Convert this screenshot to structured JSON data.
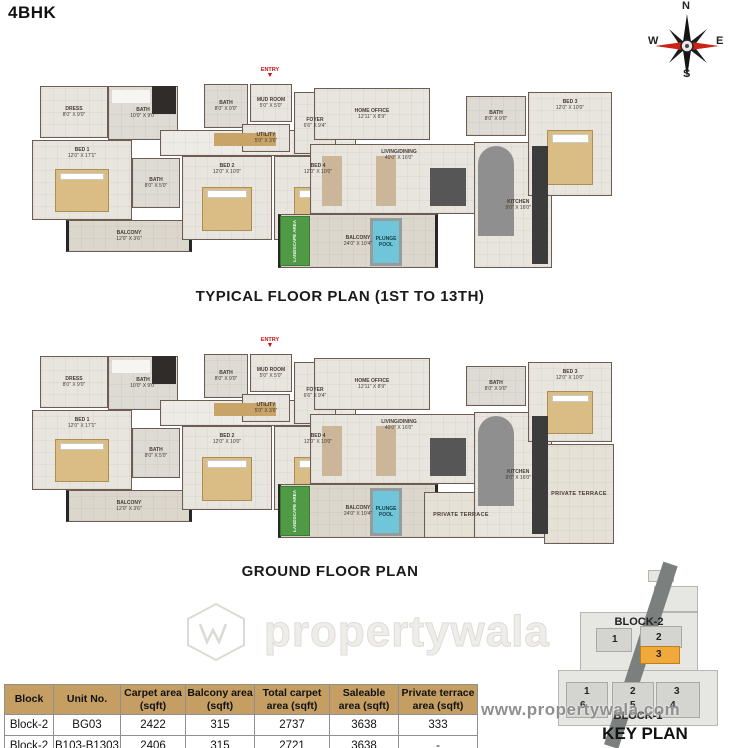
{
  "title": "4BHK",
  "compass": {
    "n": "N",
    "e": "E",
    "s": "S",
    "w": "W"
  },
  "watermark": {
    "brand": "propertywala",
    "url": "www.propertywala.com"
  },
  "plans": [
    {
      "caption": "TYPICAL FLOOR PLAN (1ST TO 13TH)",
      "entry": "ENTRY",
      "rooms": [
        {
          "n": "DRESS",
          "d": "8'0\" X 9'0\"",
          "x": 22,
          "y": 4,
          "w": 68,
          "h": 52,
          "t": "room"
        },
        {
          "n": "BATH",
          "d": "10'0\" X 9'0\"",
          "x": 90,
          "y": 4,
          "w": 70,
          "h": 54,
          "t": "bath"
        },
        {
          "n": "BED 1",
          "d": "12'0\" X 17'1\"",
          "x": 14,
          "y": 58,
          "w": 100,
          "h": 80,
          "t": "bed"
        },
        {
          "n": "BALCONY",
          "d": "12'0\" X 3'6\"",
          "x": 48,
          "y": 138,
          "w": 126,
          "h": 32,
          "t": "balc"
        },
        {
          "n": "",
          "d": "",
          "x": 142,
          "y": 48,
          "w": 196,
          "h": 26,
          "t": "hall"
        },
        {
          "n": "BATH",
          "d": "8'0\" X 5'0\"",
          "x": 114,
          "y": 76,
          "w": 48,
          "h": 50,
          "t": "bath"
        },
        {
          "n": "BED 2",
          "d": "12'0\" X 10'0\"",
          "x": 164,
          "y": 74,
          "w": 90,
          "h": 84,
          "t": "bed"
        },
        {
          "n": "BED 4",
          "d": "12'0\" X 10'0\"",
          "x": 256,
          "y": 74,
          "w": 88,
          "h": 84,
          "t": "bed"
        },
        {
          "n": "BATH",
          "d": "8'0\" X 9'0\"",
          "x": 186,
          "y": 2,
          "w": 44,
          "h": 44,
          "t": "bath"
        },
        {
          "n": "MUD ROOM",
          "d": "5'0\" X 5'0\"",
          "x": 232,
          "y": 2,
          "w": 42,
          "h": 38,
          "t": "room"
        },
        {
          "n": "UTILITY",
          "d": "5'0\" X 3'6\"",
          "x": 224,
          "y": 42,
          "w": 48,
          "h": 28,
          "t": "room"
        },
        {
          "n": "FOYER",
          "d": "6'6\" X 9'4\"",
          "x": 276,
          "y": 10,
          "w": 42,
          "h": 62,
          "t": "room"
        },
        {
          "n": "HOME OFFICE",
          "d": "12'11\" X 8'9\"",
          "x": 296,
          "y": 6,
          "w": 116,
          "h": 52,
          "t": "room"
        },
        {
          "n": "LIVING/DINING",
          "d": "40'0\" X 16'0\"",
          "x": 292,
          "y": 62,
          "w": 178,
          "h": 70,
          "t": "living"
        },
        {
          "n": "BALCONY",
          "d": "24'0\" X 10'4\"",
          "x": 260,
          "y": 132,
          "w": 160,
          "h": 54,
          "t": "balc"
        },
        {
          "n": "LANDSCAPE AREA",
          "d": "",
          "x": 262,
          "y": 134,
          "w": 30,
          "h": 50,
          "t": "green"
        },
        {
          "n": "PLUNGE POOL",
          "d": "",
          "x": 352,
          "y": 136,
          "w": 32,
          "h": 48,
          "t": "pool"
        },
        {
          "n": "KITCHEN",
          "d": "9'0\" X 16'0\"",
          "x": 456,
          "y": 60,
          "w": 78,
          "h": 126,
          "t": "kitchen"
        },
        {
          "n": "BATH",
          "d": "8'0\" X 9'0\"",
          "x": 448,
          "y": 14,
          "w": 60,
          "h": 40,
          "t": "bath"
        },
        {
          "n": "BED 3",
          "d": "12'0\" X 10'0\"",
          "x": 510,
          "y": 10,
          "w": 84,
          "h": 104,
          "t": "bed"
        },
        {
          "n": "",
          "d": "",
          "x": 134,
          "y": 4,
          "w": 24,
          "h": 28,
          "t": "decor",
          "f": "#2f2c2a"
        },
        {
          "n": "",
          "d": "",
          "x": 94,
          "y": 8,
          "w": 38,
          "h": 13,
          "t": "decor",
          "f": "#f6f5f2"
        },
        {
          "n": "",
          "d": "",
          "x": 196,
          "y": 51,
          "w": 62,
          "h": 13,
          "t": "decor",
          "f": "#c9a469"
        },
        {
          "n": "",
          "d": "",
          "x": 304,
          "y": 74,
          "w": 20,
          "h": 50,
          "t": "decor",
          "f": "#cbb69a"
        },
        {
          "n": "",
          "d": "",
          "x": 358,
          "y": 74,
          "w": 20,
          "h": 50,
          "t": "decor",
          "f": "#cbb69a"
        },
        {
          "n": "",
          "d": "",
          "x": 412,
          "y": 86,
          "w": 36,
          "h": 38,
          "t": "decor",
          "f": "#565656"
        },
        {
          "n": "",
          "d": "",
          "x": 460,
          "y": 64,
          "w": 36,
          "h": 90,
          "t": "decor",
          "f": "#8f8f8f",
          "r": "18px 18px 0 0"
        },
        {
          "n": "",
          "d": "",
          "x": 514,
          "y": 64,
          "w": 16,
          "h": 118,
          "t": "decor",
          "f": "#3c3c3c"
        }
      ]
    },
    {
      "caption": "GROUND FLOOR PLAN",
      "entry": "ENTRY",
      "rooms": [
        {
          "n": "DRESS",
          "d": "8'0\" X 9'0\"",
          "x": 22,
          "y": 4,
          "w": 68,
          "h": 52,
          "t": "room"
        },
        {
          "n": "BATH",
          "d": "10'0\" X 9'0\"",
          "x": 90,
          "y": 4,
          "w": 70,
          "h": 54,
          "t": "bath"
        },
        {
          "n": "BED 1",
          "d": "12'0\" X 17'1\"",
          "x": 14,
          "y": 58,
          "w": 100,
          "h": 80,
          "t": "bed"
        },
        {
          "n": "BALCONY",
          "d": "12'0\" X 3'6\"",
          "x": 48,
          "y": 138,
          "w": 126,
          "h": 32,
          "t": "balc"
        },
        {
          "n": "",
          "d": "",
          "x": 142,
          "y": 48,
          "w": 196,
          "h": 26,
          "t": "hall"
        },
        {
          "n": "BATH",
          "d": "8'0\" X 5'0\"",
          "x": 114,
          "y": 76,
          "w": 48,
          "h": 50,
          "t": "bath"
        },
        {
          "n": "BED 2",
          "d": "12'0\" X 10'0\"",
          "x": 164,
          "y": 74,
          "w": 90,
          "h": 84,
          "t": "bed"
        },
        {
          "n": "BED 4",
          "d": "12'0\" X 10'0\"",
          "x": 256,
          "y": 74,
          "w": 88,
          "h": 84,
          "t": "bed"
        },
        {
          "n": "BATH",
          "d": "8'0\" X 9'0\"",
          "x": 186,
          "y": 2,
          "w": 44,
          "h": 44,
          "t": "bath"
        },
        {
          "n": "MUD ROOM",
          "d": "5'0\" X 5'0\"",
          "x": 232,
          "y": 2,
          "w": 42,
          "h": 38,
          "t": "room"
        },
        {
          "n": "UTILITY",
          "d": "5'0\" X 3'6\"",
          "x": 224,
          "y": 42,
          "w": 48,
          "h": 28,
          "t": "room"
        },
        {
          "n": "FOYER",
          "d": "6'6\" X 9'4\"",
          "x": 276,
          "y": 10,
          "w": 42,
          "h": 62,
          "t": "room"
        },
        {
          "n": "HOME OFFICE",
          "d": "12'11\" X 8'9\"",
          "x": 296,
          "y": 6,
          "w": 116,
          "h": 52,
          "t": "room"
        },
        {
          "n": "LIVING/DINING",
          "d": "40'0\" X 16'0\"",
          "x": 292,
          "y": 62,
          "w": 178,
          "h": 70,
          "t": "living"
        },
        {
          "n": "BALCONY",
          "d": "24'0\" X 10'4\"",
          "x": 260,
          "y": 132,
          "w": 160,
          "h": 54,
          "t": "balc"
        },
        {
          "n": "LANDSCAPE AREA",
          "d": "",
          "x": 262,
          "y": 134,
          "w": 30,
          "h": 50,
          "t": "green"
        },
        {
          "n": "PLUNGE POOL",
          "d": "",
          "x": 352,
          "y": 136,
          "w": 32,
          "h": 48,
          "t": "pool"
        },
        {
          "n": "PRIVATE TERRACE",
          "d": "",
          "x": 406,
          "y": 140,
          "w": 74,
          "h": 46,
          "t": "terrace"
        },
        {
          "n": "KITCHEN",
          "d": "9'0\" X 16'0\"",
          "x": 456,
          "y": 60,
          "w": 78,
          "h": 126,
          "t": "kitchen"
        },
        {
          "n": "BATH",
          "d": "8'0\" X 9'0\"",
          "x": 448,
          "y": 14,
          "w": 60,
          "h": 40,
          "t": "bath"
        },
        {
          "n": "BED 3",
          "d": "12'0\" X 10'0\"",
          "x": 510,
          "y": 10,
          "w": 84,
          "h": 80,
          "t": "bed"
        },
        {
          "n": "PRIVATE TERRACE",
          "d": "",
          "x": 526,
          "y": 92,
          "w": 70,
          "h": 100,
          "t": "terrace"
        },
        {
          "n": "",
          "d": "",
          "x": 134,
          "y": 4,
          "w": 24,
          "h": 28,
          "t": "decor",
          "f": "#2f2c2a"
        },
        {
          "n": "",
          "d": "",
          "x": 94,
          "y": 8,
          "w": 38,
          "h": 13,
          "t": "decor",
          "f": "#f6f5f2"
        },
        {
          "n": "",
          "d": "",
          "x": 196,
          "y": 51,
          "w": 62,
          "h": 13,
          "t": "decor",
          "f": "#c9a469"
        },
        {
          "n": "",
          "d": "",
          "x": 304,
          "y": 74,
          "w": 20,
          "h": 50,
          "t": "decor",
          "f": "#cbb69a"
        },
        {
          "n": "",
          "d": "",
          "x": 358,
          "y": 74,
          "w": 20,
          "h": 50,
          "t": "decor",
          "f": "#cbb69a"
        },
        {
          "n": "",
          "d": "",
          "x": 412,
          "y": 86,
          "w": 36,
          "h": 38,
          "t": "decor",
          "f": "#565656"
        },
        {
          "n": "",
          "d": "",
          "x": 460,
          "y": 64,
          "w": 36,
          "h": 90,
          "t": "decor",
          "f": "#8f8f8f",
          "r": "18px 18px 0 0"
        },
        {
          "n": "",
          "d": "",
          "x": 514,
          "y": 64,
          "w": 16,
          "h": 118,
          "t": "decor",
          "f": "#3c3c3c"
        }
      ]
    }
  ],
  "area_table": {
    "headers": [
      "Block",
      "Unit No.",
      "Carpet area (sqft)",
      "Balcony area (sqft)",
      "Total carpet area (sqft)",
      "Saleable area (sqft)",
      "Private terrace area (sqft)"
    ],
    "rows": [
      [
        "Block-2",
        "BG03",
        "2422",
        "315",
        "2737",
        "3638",
        "333"
      ],
      [
        "Block-2",
        "B103-B1303",
        "2406",
        "315",
        "2721",
        "3638",
        "-"
      ]
    ]
  },
  "key_plan": {
    "caption": "KEY PLAN",
    "block2_label": "BLOCK-2",
    "block1_label": "BLOCK-1",
    "highlight_color": "#f2a93b",
    "block2_units": [
      {
        "num": "1",
        "x": 56,
        "y": 68
      },
      {
        "num": "2",
        "x": 100,
        "y": 66
      },
      {
        "num": "3",
        "x": 100,
        "y": 83,
        "hl": true
      }
    ],
    "block1_units": [
      {
        "num": "1",
        "x": 28,
        "y": 120
      },
      {
        "num": "2",
        "x": 74,
        "y": 120
      },
      {
        "num": "3",
        "x": 118,
        "y": 120
      },
      {
        "num": "6",
        "x": 24,
        "y": 134
      },
      {
        "num": "5",
        "x": 74,
        "y": 134
      },
      {
        "num": "4",
        "x": 114,
        "y": 134
      }
    ]
  }
}
